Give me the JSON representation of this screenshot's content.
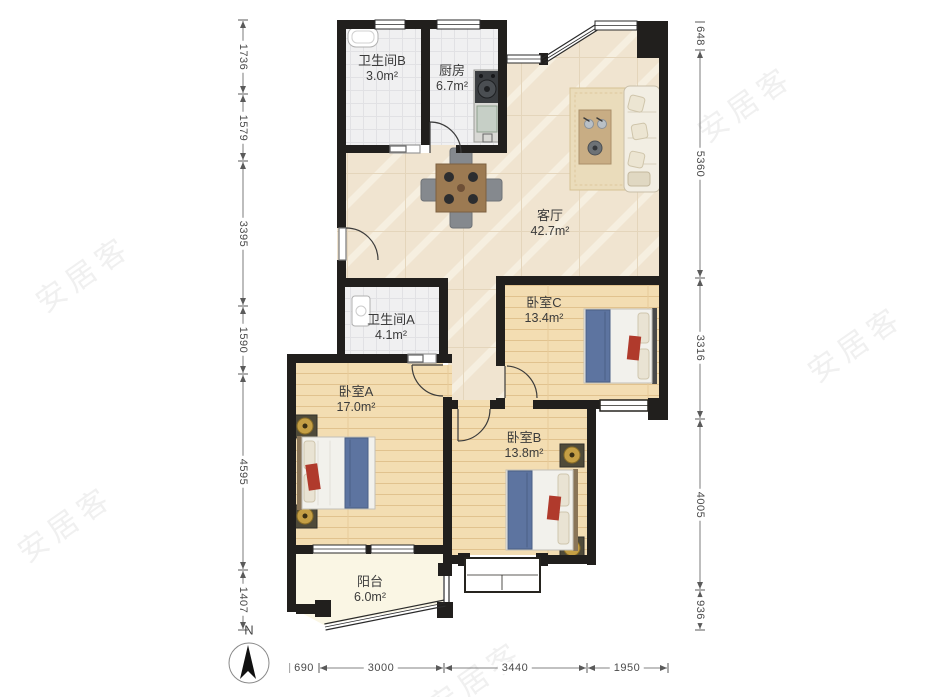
{
  "compass": {
    "label": "N"
  },
  "watermark": "安居客",
  "rooms": [
    {
      "name": "卫生间B",
      "area": "3.0m²"
    },
    {
      "name": "厨房",
      "area": "6.7m²"
    },
    {
      "name": "客厅",
      "area": "42.7m²"
    },
    {
      "name": "卫生间A",
      "area": "4.1m²"
    },
    {
      "name": "卧室A",
      "area": "17.0m²"
    },
    {
      "name": "卧室B",
      "area": "13.8m²"
    },
    {
      "name": "卧室C",
      "area": "13.4m²"
    },
    {
      "name": "阳台",
      "area": "6.0m²"
    }
  ],
  "dimensions": {
    "left": [
      "1736",
      "1579",
      "3395",
      "1590",
      "4595",
      "1407"
    ],
    "right": [
      "648",
      "5360",
      "3316",
      "4005",
      "936"
    ],
    "bottom": [
      "690",
      "3000",
      "3440",
      "1950"
    ]
  },
  "colors": {
    "wall": "#211f1d",
    "marble_floor": "#f0e4d0",
    "wood_floor": "#f3ddb2",
    "tile_floor": "#f0f0f1",
    "balcony_floor": "#faf6e4",
    "bed_blanket": "#5d74a0",
    "accent_red": "#b03a2c",
    "dimension_text": "#4a4a4a"
  }
}
